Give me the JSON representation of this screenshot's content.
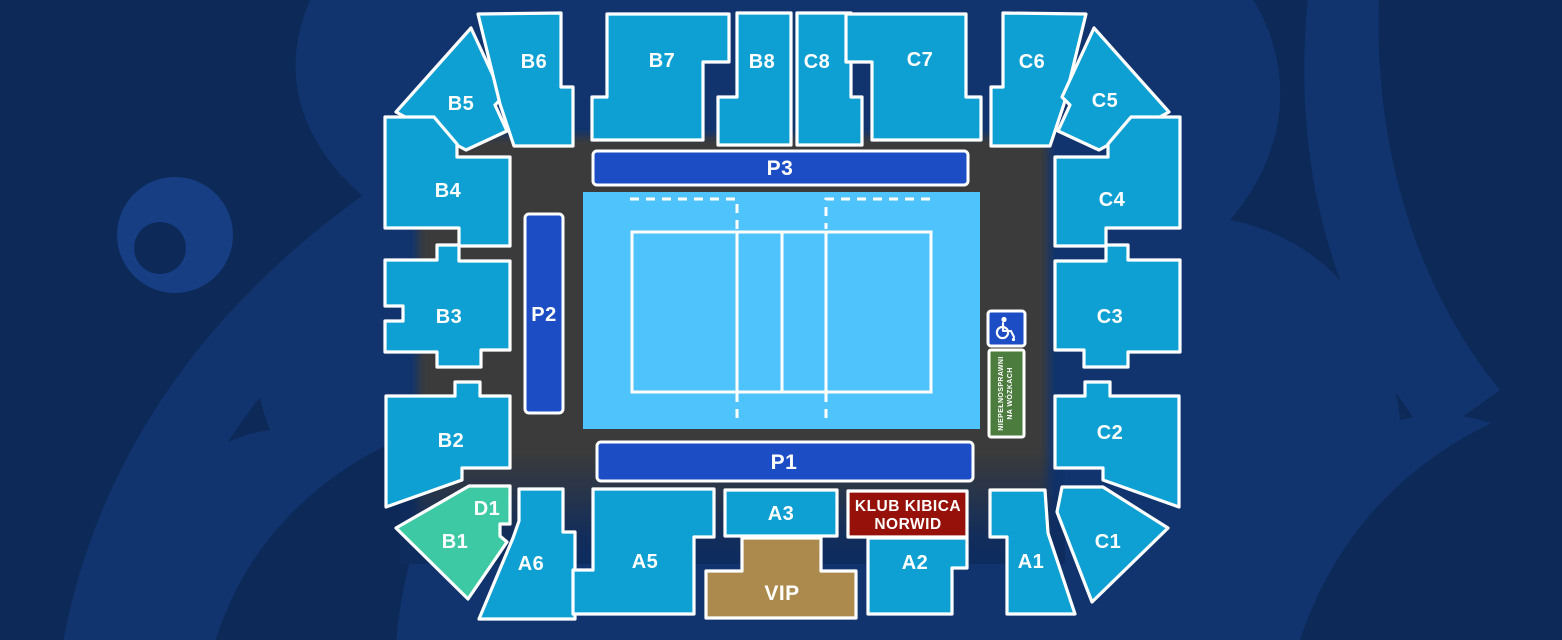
{
  "colors": {
    "background": "#11346E",
    "watermark_dark": "#0C2958",
    "watermark_light": "#173E82",
    "floor": "#3A3A3A",
    "section": "#0FA0D3",
    "section_teal": "#3EC9A5",
    "vip_gold": "#AC8A4D",
    "klub_red": "#951109",
    "p_bar": "#1D4DC5",
    "court_outer": "#4FC3FC",
    "court_inner": "#FF867B",
    "wheelchair_green": "#4C7C3E"
  },
  "sections": {
    "b5": {
      "label": "B5"
    },
    "b6": {
      "label": "B6"
    },
    "b7": {
      "label": "B7"
    },
    "b8": {
      "label": "B8"
    },
    "c8": {
      "label": "C8"
    },
    "c7": {
      "label": "C7"
    },
    "c6": {
      "label": "C6"
    },
    "c5": {
      "label": "C5"
    },
    "b4": {
      "label": "B4"
    },
    "b3": {
      "label": "B3"
    },
    "b2": {
      "label": "B2"
    },
    "b1": {
      "label": "B1"
    },
    "d1": {
      "label": "D1"
    },
    "a6": {
      "label": "A6"
    },
    "a5": {
      "label": "A5"
    },
    "a3": {
      "label": "A3"
    },
    "a2": {
      "label": "A2"
    },
    "a1": {
      "label": "A1"
    },
    "c1": {
      "label": "C1"
    },
    "c2": {
      "label": "C2"
    },
    "c3": {
      "label": "C3"
    },
    "c4": {
      "label": "C4"
    },
    "p1": {
      "label": "P1"
    },
    "p2": {
      "label": "P2"
    },
    "p3": {
      "label": "P3"
    },
    "vip": {
      "label": "VIP"
    }
  },
  "klub": {
    "line1": "KLUB KIBICA",
    "line2": "NORWID"
  },
  "accessibility": {
    "line1": "NIEPEŁNOSPRAWNI",
    "line2": "NA WÓZKACH"
  }
}
